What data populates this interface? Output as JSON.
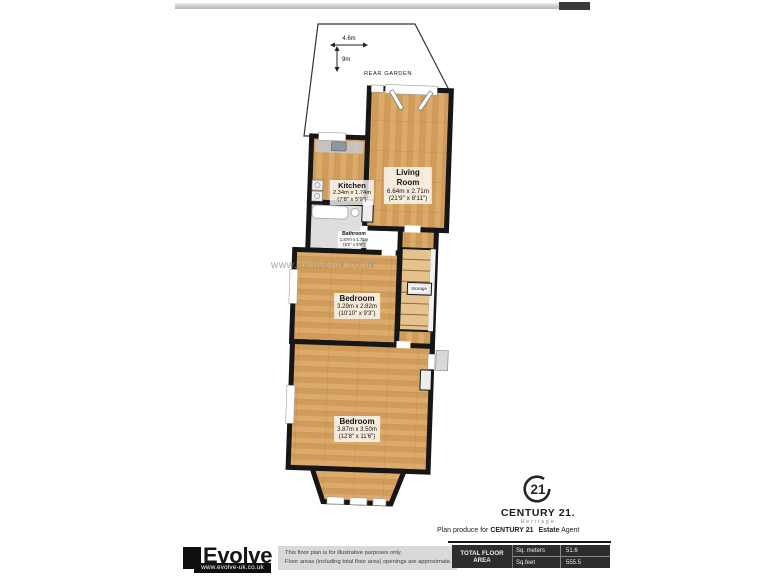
{
  "garden": {
    "label": "REAR GARDEN",
    "width": "4.6m",
    "depth": "9m"
  },
  "watermark": {
    "text": "www.evolve-uk.co.uk"
  },
  "rooms": {
    "living_room": {
      "name_line1": "Living",
      "name_line2": "Room",
      "metric": "6.64m x 2.71m",
      "imperial": "(21'9\" x 8'11\")"
    },
    "kitchen": {
      "name": "Kitchen",
      "metric": "2.34m x 1.74m",
      "imperial": "(7'8\" x 5'9\")"
    },
    "bathroom": {
      "name": "Bathroom",
      "metric": "1.87m x 1.75m",
      "imperial": "(6'2\" x 5'9\")"
    },
    "bedroom_middle": {
      "name": "Bedroom",
      "metric": "3.29m x 2.82m",
      "imperial": "(10'10\" x 9'3\")"
    },
    "bedroom_front": {
      "name": "Bedroom",
      "metric": "3.87m x 3.50m",
      "imperial": "(12'8\" x 11'6\")"
    },
    "storage": {
      "name": "Storage"
    }
  },
  "branding": {
    "century21": {
      "badge_number": "21",
      "brand": "CENTURY 21.",
      "division": "Heritage"
    },
    "credit": {
      "prefix": "Plan produce for ",
      "bold1": "CENTURY 21",
      "bold2": "Estate",
      "suffix": " Agent"
    }
  },
  "evolve": {
    "brand": "Evolve",
    "url": "www.evolve-uk.co.uk"
  },
  "footer": {
    "disclaimer1": "This floor plan is for illustrative purposes only.",
    "disclaimer2": "Floor areas (including total floor area) openings are approximate.",
    "area_table": {
      "title": "TOTAL FLOOR AREA",
      "rows": [
        {
          "unit": "Sq. meters",
          "value": "51.6"
        },
        {
          "unit": "Sq.feet",
          "value": "555.5"
        }
      ]
    }
  },
  "colors": {
    "wall": "#161616",
    "wood_light": "#dcab6c",
    "wood_dark": "#d09c59",
    "table_bg": "#2d2d2d"
  }
}
